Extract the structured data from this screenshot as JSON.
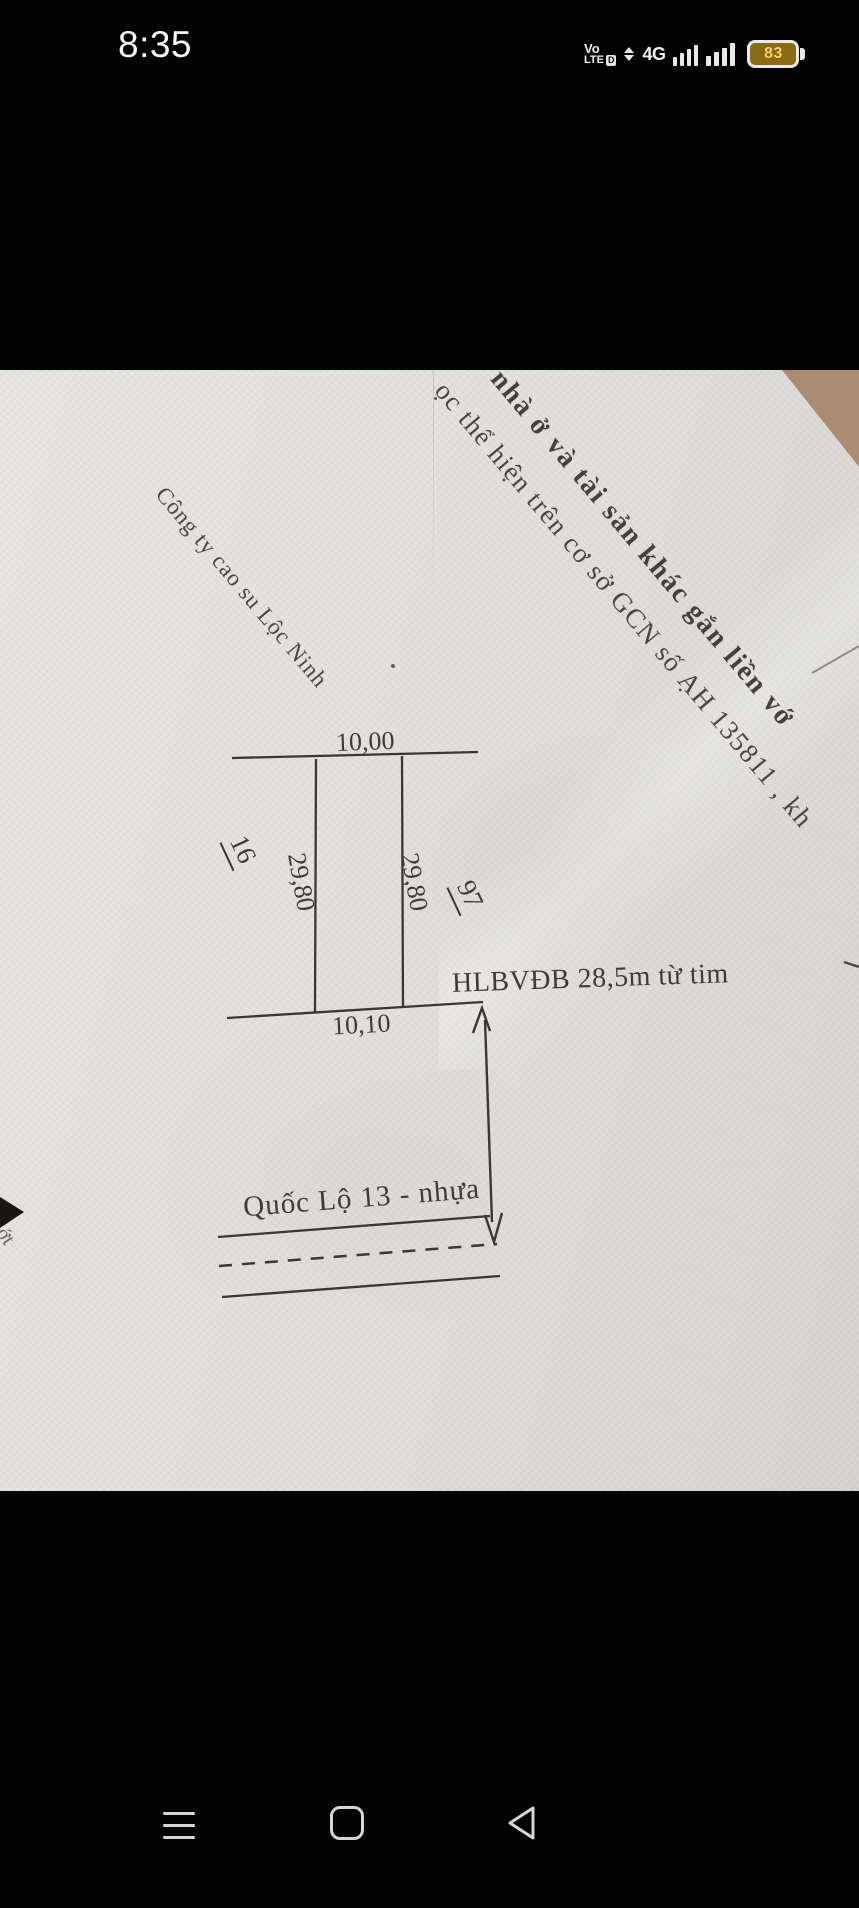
{
  "status_bar": {
    "time": "8:35",
    "volte_line1": "Vo",
    "volte_line2": "LTE",
    "hd_label": "D",
    "network": "4G",
    "battery_percent": "83"
  },
  "photo": {
    "gcn_text_line1": "nhà ở và tài sản khác gắn liền vớ",
    "gcn_text_line2": "ọc thể hiện trên cơ sở GCN số ẠH 135811 , kh",
    "company_label": "Công ty cao su Lộc Ninh",
    "plot": {
      "top_width": "10,00",
      "bottom_width": "10,10",
      "left_depth": "29,80",
      "right_depth": "29,80",
      "parcel_left": "16",
      "parcel_right": "97"
    },
    "setback_label": "HLBVĐB 28,5m từ tim",
    "road_label": "Quốc Lộ 13 - nhựa",
    "edge_text": "ớt"
  },
  "colors": {
    "battery_fill": "#8a6b15",
    "battery_text": "#ffd466",
    "paper": "#e3e1de",
    "ink": "#3a3632",
    "background_corner": "#b6977f"
  }
}
